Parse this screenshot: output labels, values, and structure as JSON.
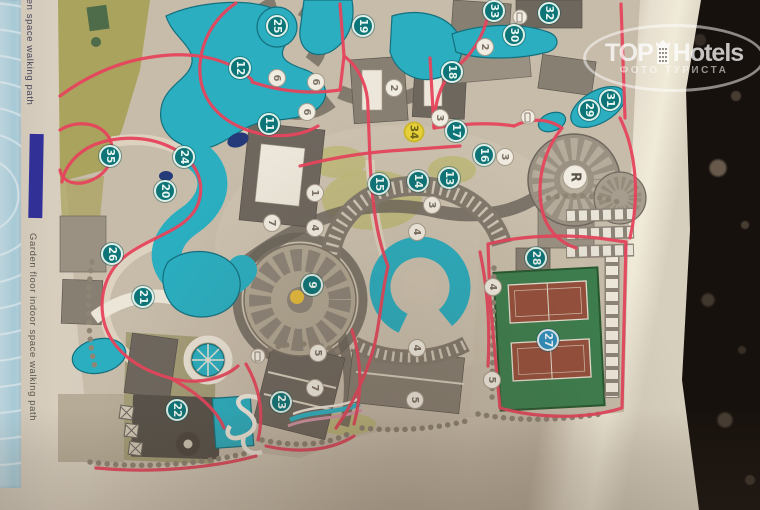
{
  "legend": {
    "open_label": "open space walking path",
    "garden_label": "Garden floor indoor space walking path"
  },
  "watermark": {
    "brand_top": "TOP",
    "brand_bottom": "Hotels",
    "subtitle": "ФОТО ТУРИСТА"
  },
  "map": {
    "markers": [
      {
        "label": "25",
        "kind": "teal",
        "x": 277,
        "y": 26
      },
      {
        "label": "19",
        "kind": "teal",
        "x": 363,
        "y": 26
      },
      {
        "label": "33",
        "kind": "teal",
        "x": 494,
        "y": 11
      },
      {
        "label": "32",
        "kind": "teal",
        "x": 549,
        "y": 13
      },
      {
        "label": "30",
        "kind": "teal",
        "x": 514,
        "y": 35
      },
      {
        "label": "12",
        "kind": "teal",
        "x": 240,
        "y": 68
      },
      {
        "label": "18",
        "kind": "teal",
        "x": 452,
        "y": 72
      },
      {
        "label": "11",
        "kind": "teal",
        "x": 269,
        "y": 124
      },
      {
        "label": "31",
        "kind": "teal",
        "x": 610,
        "y": 100
      },
      {
        "label": "29",
        "kind": "teal",
        "x": 589,
        "y": 110
      },
      {
        "label": "17",
        "kind": "teal",
        "x": 456,
        "y": 131
      },
      {
        "label": "35",
        "kind": "teal",
        "x": 110,
        "y": 156
      },
      {
        "label": "24",
        "kind": "teal",
        "x": 184,
        "y": 157
      },
      {
        "label": "16",
        "kind": "teal",
        "x": 484,
        "y": 155
      },
      {
        "label": "13",
        "kind": "teal",
        "x": 449,
        "y": 178
      },
      {
        "label": "14",
        "kind": "teal",
        "x": 418,
        "y": 181
      },
      {
        "label": "15",
        "kind": "teal",
        "x": 379,
        "y": 184
      },
      {
        "label": "20",
        "kind": "teal",
        "x": 165,
        "y": 191
      },
      {
        "label": "26",
        "kind": "teal",
        "x": 112,
        "y": 254
      },
      {
        "label": "28",
        "kind": "teal",
        "x": 536,
        "y": 258
      },
      {
        "label": "9",
        "kind": "teal",
        "x": 312,
        "y": 285
      },
      {
        "label": "21",
        "kind": "teal",
        "x": 143,
        "y": 297
      },
      {
        "label": "27",
        "kind": "blue",
        "x": 548,
        "y": 340
      },
      {
        "label": "23",
        "kind": "teal",
        "x": 281,
        "y": 402
      },
      {
        "label": "22",
        "kind": "teal",
        "x": 177,
        "y": 410
      },
      {
        "label": "34",
        "kind": "yellow",
        "x": 414,
        "y": 132
      },
      {
        "label": "R",
        "kind": "r",
        "x": 575,
        "y": 177
      },
      {
        "label": "6",
        "kind": "white",
        "x": 277,
        "y": 78
      },
      {
        "label": "6",
        "kind": "white",
        "x": 316,
        "y": 82
      },
      {
        "label": "6",
        "kind": "white",
        "x": 307,
        "y": 112
      },
      {
        "label": "2",
        "kind": "white",
        "x": 394,
        "y": 88
      },
      {
        "label": "2",
        "kind": "white",
        "x": 485,
        "y": 47
      },
      {
        "label": "3",
        "kind": "white",
        "x": 440,
        "y": 118
      },
      {
        "label": "3",
        "kind": "white",
        "x": 505,
        "y": 157
      },
      {
        "label": "3",
        "kind": "white",
        "x": 432,
        "y": 205
      },
      {
        "label": "1",
        "kind": "white",
        "x": 315,
        "y": 193
      },
      {
        "label": "7",
        "kind": "white",
        "x": 272,
        "y": 223
      },
      {
        "label": "4",
        "kind": "white",
        "x": 315,
        "y": 228
      },
      {
        "label": "4",
        "kind": "white",
        "x": 417,
        "y": 232
      },
      {
        "label": "4",
        "kind": "white",
        "x": 493,
        "y": 287
      },
      {
        "label": "4",
        "kind": "white",
        "x": 417,
        "y": 348
      },
      {
        "label": "5",
        "kind": "white",
        "x": 318,
        "y": 353
      },
      {
        "label": "5",
        "kind": "white",
        "x": 492,
        "y": 380
      },
      {
        "label": "5",
        "kind": "white",
        "x": 415,
        "y": 400
      },
      {
        "label": "7",
        "kind": "white",
        "x": 315,
        "y": 388
      },
      {
        "label": "",
        "kind": "icon",
        "x": 520,
        "y": 17
      },
      {
        "label": "",
        "kind": "icon",
        "x": 528,
        "y": 117
      },
      {
        "label": "",
        "kind": "icon",
        "x": 258,
        "y": 356
      }
    ]
  },
  "colors": {
    "paper": "#d3c9b8",
    "table_granite": "#17110d",
    "pool_teal": "#2aaec0",
    "path_red": "#e6455c",
    "marker_teal": "#0d7478",
    "marker_yellow": "#e7d23a",
    "marker_blue": "#2e8fc0",
    "tennis_green": "#3c7f4e",
    "court_clay": "#96503c",
    "legend_swatch_blue": "#31309a",
    "olive_green": "#a9a35d"
  }
}
